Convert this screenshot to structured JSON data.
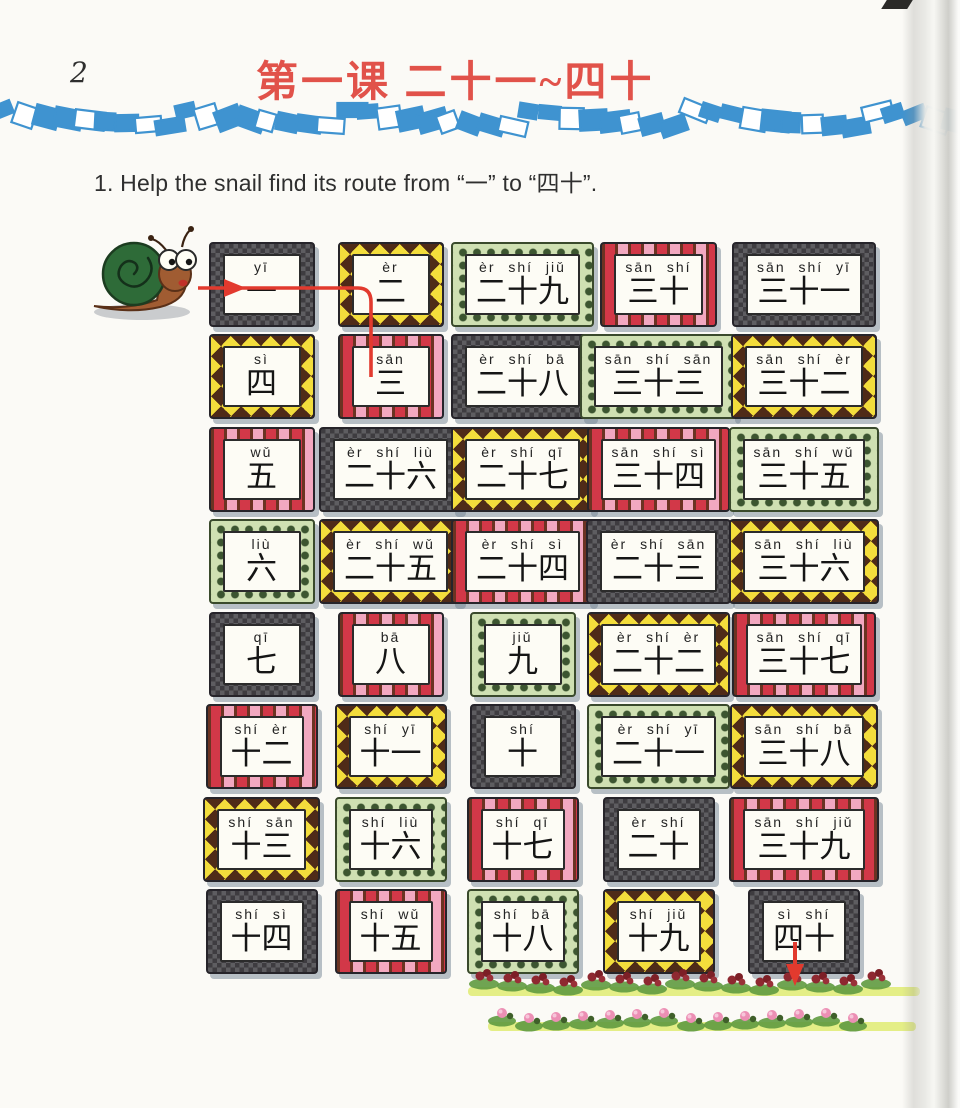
{
  "page": {
    "number": "2",
    "title": "第一课 二十一~四十",
    "instruction": "1. Help the snail find its route from “一” to “四十”."
  },
  "route": {
    "start_label": "一",
    "end_label": "四十",
    "drawn_through": [
      "一",
      "二",
      "三"
    ]
  },
  "illustrations": {
    "snail": "snail",
    "flower_bed": "flower border",
    "band": "blue paper-scrap divider"
  },
  "colors": {
    "title_red": "#e1524a",
    "band_blue": "#3f93d0",
    "route_red": "#e23a2e",
    "frame_dark": "#3e3c40",
    "frame_brown": "#5a2f1e",
    "frame_yellow": "#f3dd3c",
    "frame_check_red": "#d23848",
    "frame_check_pink": "#f2a8c0",
    "frame_green_bg": "#cfe0b2",
    "frame_green_dot": "#3c5530"
  },
  "cards": [
    {
      "pinyin": "yī",
      "hanzi": "一",
      "style": "black"
    },
    {
      "pinyin": "èr",
      "hanzi": "二",
      "style": "yellow"
    },
    {
      "pinyin": "èr shí jiǔ",
      "hanzi": "二十九",
      "style": "green"
    },
    {
      "pinyin": "sān shí",
      "hanzi": "三十",
      "style": "red"
    },
    {
      "pinyin": "sān shí yī",
      "hanzi": "三十一",
      "style": "black"
    },
    {
      "pinyin": "sì",
      "hanzi": "四",
      "style": "yellow"
    },
    {
      "pinyin": "sān",
      "hanzi": "三",
      "style": "red"
    },
    {
      "pinyin": "èr shí bā",
      "hanzi": "二十八",
      "style": "black"
    },
    {
      "pinyin": "sān shí sān",
      "hanzi": "三十三",
      "style": "green"
    },
    {
      "pinyin": "sān shí èr",
      "hanzi": "三十二",
      "style": "yellow"
    },
    {
      "pinyin": "wǔ",
      "hanzi": "五",
      "style": "red"
    },
    {
      "pinyin": "èr shí liù",
      "hanzi": "二十六",
      "style": "black"
    },
    {
      "pinyin": "èr shí qī",
      "hanzi": "二十七",
      "style": "yellow"
    },
    {
      "pinyin": "sān shí sì",
      "hanzi": "三十四",
      "style": "red"
    },
    {
      "pinyin": "sān shí wǔ",
      "hanzi": "三十五",
      "style": "green"
    },
    {
      "pinyin": "liù",
      "hanzi": "六",
      "style": "green"
    },
    {
      "pinyin": "èr shí wǔ",
      "hanzi": "二十五",
      "style": "yellow"
    },
    {
      "pinyin": "èr shí sì",
      "hanzi": "二十四",
      "style": "red"
    },
    {
      "pinyin": "èr shí sān",
      "hanzi": "二十三",
      "style": "black"
    },
    {
      "pinyin": "sān shí liù",
      "hanzi": "三十六",
      "style": "yellow"
    },
    {
      "pinyin": "qī",
      "hanzi": "七",
      "style": "black"
    },
    {
      "pinyin": "bā",
      "hanzi": "八",
      "style": "red"
    },
    {
      "pinyin": "jiǔ",
      "hanzi": "九",
      "style": "green"
    },
    {
      "pinyin": "èr shí èr",
      "hanzi": "二十二",
      "style": "yellow"
    },
    {
      "pinyin": "sān shí qī",
      "hanzi": "三十七",
      "style": "red"
    },
    {
      "pinyin": "shí èr",
      "hanzi": "十二",
      "style": "red"
    },
    {
      "pinyin": "shí yī",
      "hanzi": "十一",
      "style": "yellow"
    },
    {
      "pinyin": "shí",
      "hanzi": "十",
      "style": "black"
    },
    {
      "pinyin": "èr shí yī",
      "hanzi": "二十一",
      "style": "green"
    },
    {
      "pinyin": "sān shí bā",
      "hanzi": "三十八",
      "style": "yellow"
    },
    {
      "pinyin": "shí sān",
      "hanzi": "十三",
      "style": "yellow"
    },
    {
      "pinyin": "shí liù",
      "hanzi": "十六",
      "style": "green"
    },
    {
      "pinyin": "shí qī",
      "hanzi": "十七",
      "style": "red"
    },
    {
      "pinyin": "èr shí",
      "hanzi": "二十",
      "style": "black"
    },
    {
      "pinyin": "sān shí jiǔ",
      "hanzi": "三十九",
      "style": "red"
    },
    {
      "pinyin": "shí sì",
      "hanzi": "十四",
      "style": "black"
    },
    {
      "pinyin": "shí wǔ",
      "hanzi": "十五",
      "style": "red"
    },
    {
      "pinyin": "shí bā",
      "hanzi": "十八",
      "style": "green"
    },
    {
      "pinyin": "shí jiǔ",
      "hanzi": "十九",
      "style": "yellow"
    },
    {
      "pinyin": "sì shí",
      "hanzi": "四十",
      "style": "black"
    }
  ]
}
